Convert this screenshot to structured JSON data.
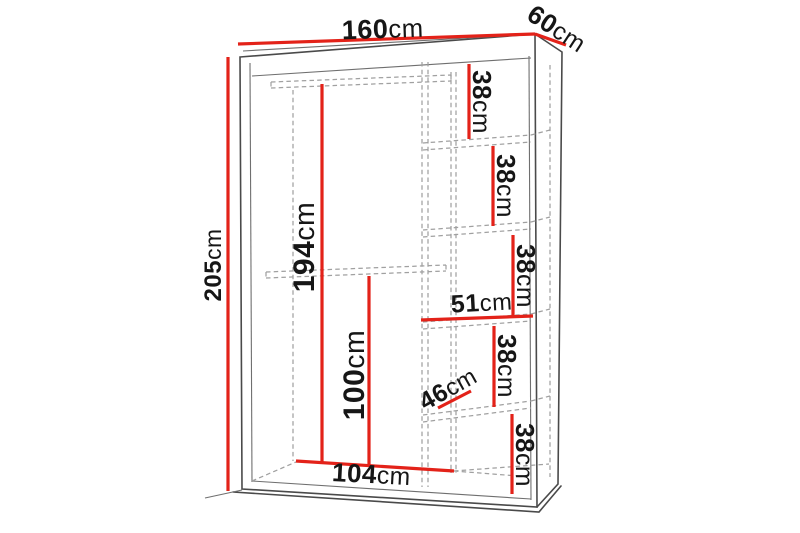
{
  "diagram": {
    "name": "Wardrobe dimension diagram",
    "colors": {
      "dimension_red": "#e32219",
      "outline_gray": "#4a4a4a",
      "hidden_line_gray": "#a0a0a0",
      "label_black": "#161616"
    },
    "labels": {
      "width": {
        "value": "160",
        "unit": "cm"
      },
      "depth": {
        "value": "60",
        "unit": "cm"
      },
      "height": {
        "value": "205",
        "unit": "cm"
      },
      "upper_rail_height": {
        "value": "194",
        "unit": "cm"
      },
      "lower_rail_height": {
        "value": "100",
        "unit": "cm"
      },
      "interior_width": {
        "value": "104",
        "unit": "cm"
      },
      "shelf_width": {
        "value": "51",
        "unit": "cm"
      },
      "shelf_depth": {
        "value": "46",
        "unit": "cm"
      },
      "shelf_gap_1": {
        "value": "38",
        "unit": "cm"
      },
      "shelf_gap_2": {
        "value": "38",
        "unit": "cm"
      },
      "shelf_gap_3": {
        "value": "38",
        "unit": "cm"
      },
      "shelf_gap_4": {
        "value": "38",
        "unit": "cm"
      },
      "shelf_gap_5": {
        "value": "38",
        "unit": "cm"
      }
    }
  }
}
